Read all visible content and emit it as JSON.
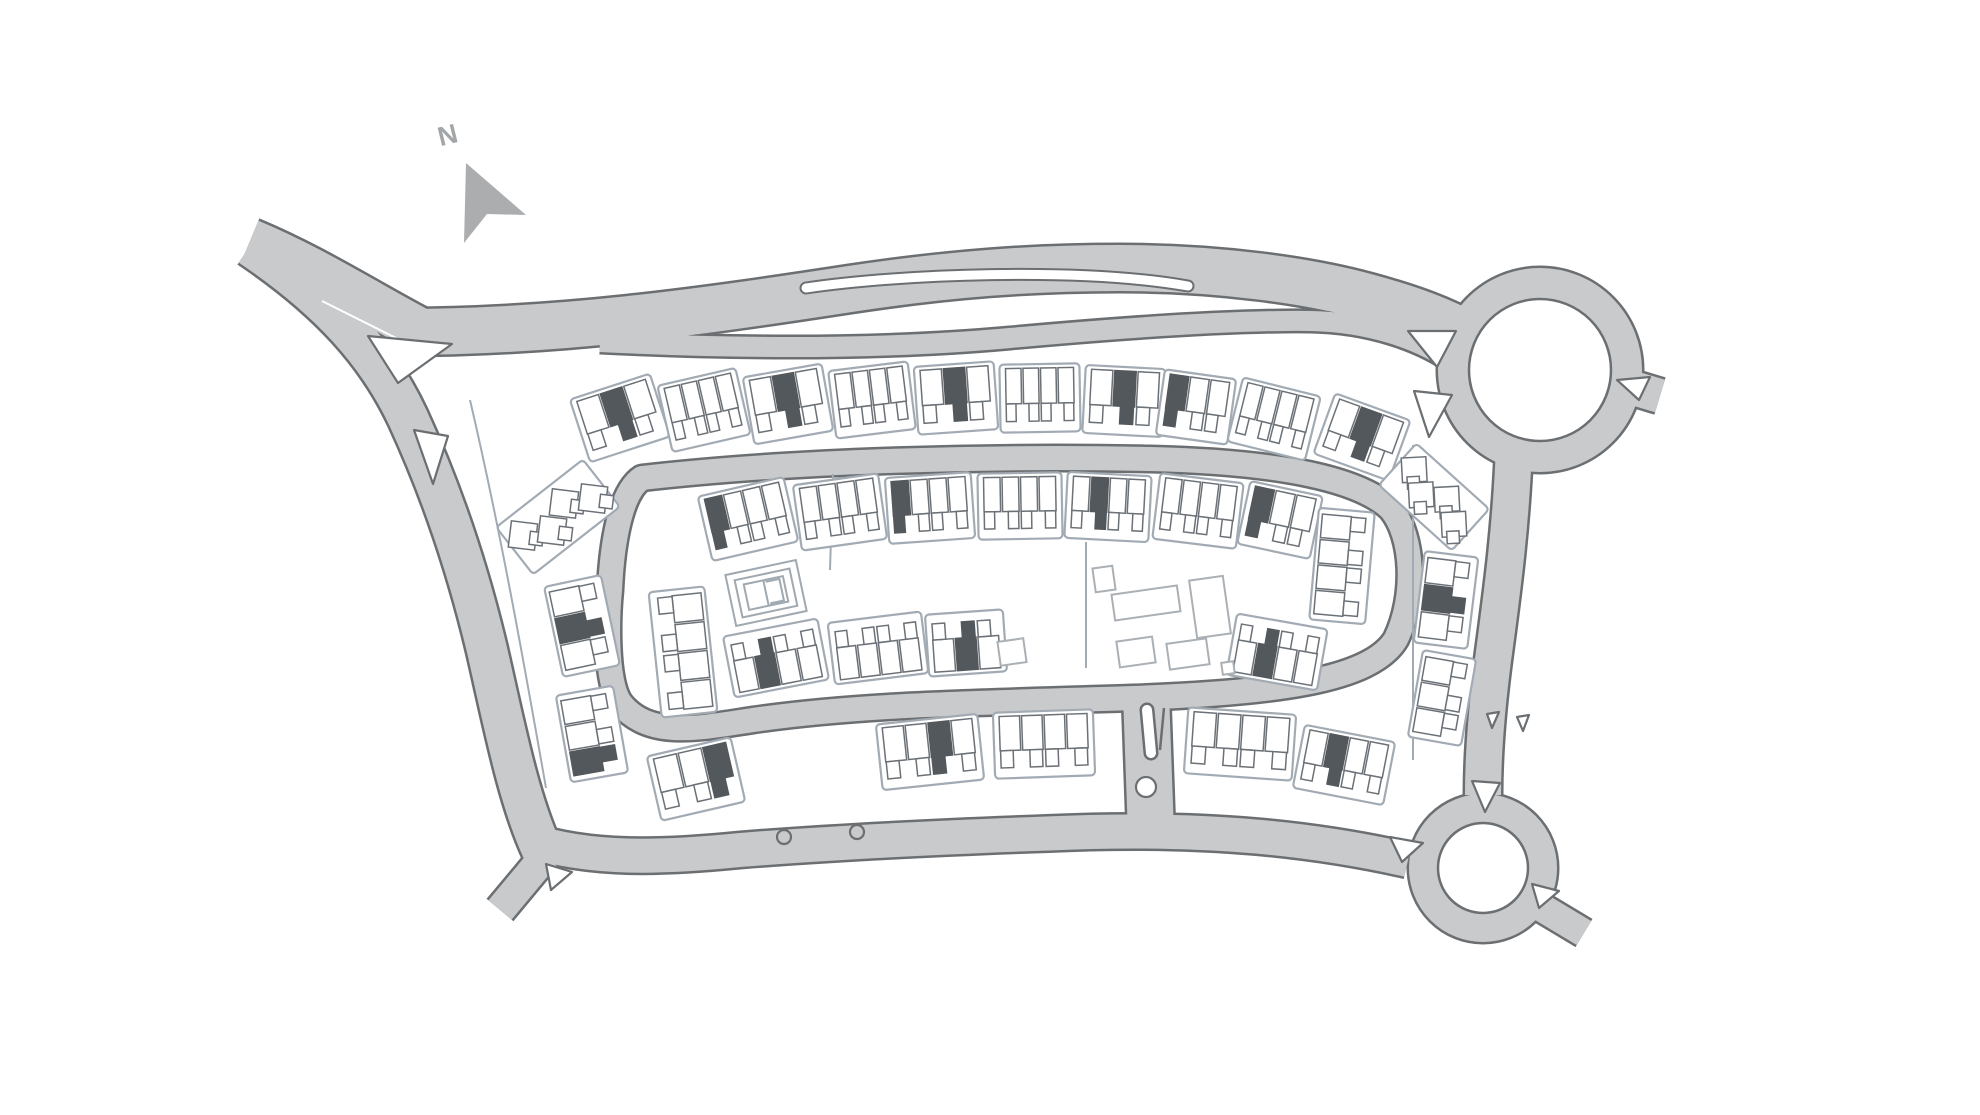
{
  "meta": {
    "title": "Development site plan"
  },
  "palette": {
    "background": "#ffffff",
    "road_fill": "#c9cacc",
    "road_casing": "#6b6f72",
    "parcel_stroke": "#a2abb4",
    "house_stroke": "#6b7177",
    "house_fill": "#ffffff",
    "unit_dark": "#53585c",
    "community_stroke": "#aab0b5",
    "play_stroke": "#a0a8b0",
    "arrow_fill": "#abadae",
    "label_color": "#a3a6a8",
    "lane_line": "#ffffff"
  },
  "compass": {
    "label": "N",
    "arrow_points": "466,163 526,215 487,214 464,243",
    "label_x": 438,
    "label_y": 120,
    "label_rotation": -14
  },
  "roads": [
    {
      "id": "entry-west",
      "d": "M 250,241 C 310,266 360,298 416,328",
      "w": 44
    },
    {
      "id": "main-avenue",
      "d": "M 398,332 C 560,332 700,312 850,289 C 950,274 1030,268 1120,268 C 1220,268 1310,281 1368,297 C 1412,309 1444,321 1470,336",
      "w": 46
    },
    {
      "id": "service-road",
      "d": "M 600,342 C 760,350 900,348 1010,338 C 1120,328 1230,320 1310,321 C 1370,322 1420,340 1452,362",
      "w": 20
    },
    {
      "id": "west-boundary",
      "d": "M 250,246 C 330,300 378,354 408,418 C 443,494 468,570 487,650 C 504,724 518,798 542,850",
      "w": 40
    },
    {
      "id": "south-boundary",
      "d": "M 528,840 C 590,860 660,858 740,850 C 840,842 970,836 1090,832 C 1210,829 1310,838 1408,860",
      "w": 34
    },
    {
      "id": "southwest-exit",
      "d": "M 545,856 L 500,910",
      "w": 30
    },
    {
      "id": "east-link",
      "d": "M 1514,446 C 1511,530 1501,600 1493,660 C 1487,706 1483,752 1483,795",
      "w": 36
    },
    {
      "id": "northeast-exit",
      "d": "M 1620,384 L 1660,396",
      "w": 34
    },
    {
      "id": "southeast-exit",
      "d": "M 1524,897 L 1584,933",
      "w": 28
    },
    {
      "id": "spine-connector",
      "d": "M 1146,694 L 1151,834",
      "w": 46
    },
    {
      "id": "inner-loop",
      "d": "M 642,478 C 800,460 1000,456 1150,459 C 1280,462 1360,479 1391,509 C 1414,537 1416,597 1396,639 C 1371,681 1273,693 1133,698 C 983,703 863,704 753,720 C 700,728 649,739 621,704 C 604,682 608,610 610,590 C 612,545 620,492 642,478 Z",
      "w": 24
    }
  ],
  "roundabouts": [
    {
      "id": "north",
      "cx": 1540,
      "cy": 370,
      "ring_r": 87,
      "ring_w": 30,
      "island_r": 71
    },
    {
      "id": "south",
      "cx": 1483,
      "cy": 868,
      "ring_r": 60,
      "ring_w": 28,
      "island_r": 45
    }
  ],
  "layby": {
    "d": "M 806,288 C 900,274 1080,267 1188,286",
    "casing_w": 13,
    "fill_w": 9
  },
  "lane_lines": [
    {
      "d": "M 322,301 L 452,366",
      "w": 2
    }
  ],
  "islands": [
    {
      "id": "fork-north",
      "points": "368,336 452,344 398,383"
    },
    {
      "id": "fork-south",
      "points": "414,430 448,436 433,484"
    },
    {
      "id": "rb-north-west",
      "points": "1408,331 1456,331 1437,367"
    },
    {
      "id": "rb-north-southwest",
      "points": "1414,391 1452,395 1429,437"
    },
    {
      "id": "rb-north-east",
      "points": "1617,380 1650,377 1639,400"
    },
    {
      "id": "rb-south-north",
      "points": "1472,781 1500,783 1485,812"
    },
    {
      "id": "rb-south-west",
      "points": "1390,837 1423,843 1402,862"
    },
    {
      "id": "rb-south-southeast",
      "points": "1532,884 1559,891 1539,908"
    },
    {
      "id": "southwest-corner",
      "points": "546,864 572,872 551,890"
    },
    {
      "id": "east-link-notch-a",
      "points": "1487,714 1499,712 1492,728"
    },
    {
      "id": "east-link-notch-b",
      "points": "1517,717 1529,715 1523,731"
    }
  ],
  "median_ovals": [
    {
      "d": "M 1147,710 L 1151,753",
      "casing_w": 15,
      "fill_w": 10
    }
  ],
  "median_circle": {
    "cx": 1146,
    "cy": 787,
    "r": 10
  },
  "median_slit": {
    "d": "M 1164,708 L 1160,750",
    "w": 2.5
  },
  "kerb_bumps": [
    {
      "cx": 784,
      "cy": 837,
      "r": 7
    },
    {
      "cx": 857,
      "cy": 832,
      "r": 7
    }
  ],
  "lot_lines": [
    "M 833,474 L 830,570",
    "M 1086,542 L 1086,668",
    "M 470,400 C 498,520 520,640 546,788",
    "M 1413,445 L 1413,760"
  ],
  "parcels": [
    {
      "id": "north-outer-1",
      "cx": 620,
      "cy": 418,
      "angle": -18,
      "len": 84,
      "depth": 66,
      "units": 3,
      "dark": [
        1
      ]
    },
    {
      "id": "north-outer-2",
      "cx": 704,
      "cy": 410,
      "angle": -13,
      "len": 80,
      "depth": 68,
      "units": 4,
      "dark": []
    },
    {
      "id": "north-outer-3",
      "cx": 788,
      "cy": 404,
      "angle": -10,
      "len": 80,
      "depth": 68,
      "units": 3,
      "dark": [
        1
      ]
    },
    {
      "id": "north-outer-4",
      "cx": 872,
      "cy": 400,
      "angle": -7,
      "len": 80,
      "depth": 68,
      "units": 4,
      "dark": []
    },
    {
      "id": "north-outer-5",
      "cx": 956,
      "cy": 398,
      "angle": -4,
      "len": 80,
      "depth": 68,
      "units": 3,
      "dark": [
        1
      ]
    },
    {
      "id": "north-outer-6",
      "cx": 1040,
      "cy": 398,
      "angle": -1,
      "len": 80,
      "depth": 68,
      "units": 4,
      "dark": []
    },
    {
      "id": "north-outer-7",
      "cx": 1124,
      "cy": 401,
      "angle": 3,
      "len": 80,
      "depth": 68,
      "units": 3,
      "dark": [
        1
      ]
    },
    {
      "id": "north-outer-8",
      "cx": 1196,
      "cy": 407,
      "angle": 8,
      "len": 72,
      "depth": 66,
      "units": 3,
      "dark": [
        0
      ]
    },
    {
      "id": "north-outer-9",
      "cx": 1274,
      "cy": 419,
      "angle": 14,
      "len": 80,
      "depth": 66,
      "units": 4,
      "dark": []
    },
    {
      "id": "north-outer-10",
      "cx": 1362,
      "cy": 437,
      "angle": 20,
      "len": 80,
      "depth": 64,
      "units": 3,
      "dark": [
        1
      ]
    },
    {
      "id": "north-inner-1",
      "cx": 748,
      "cy": 519,
      "angle": -13,
      "len": 88,
      "depth": 66,
      "units": 4,
      "dark": [
        0
      ]
    },
    {
      "id": "north-inner-2",
      "cx": 840,
      "cy": 512,
      "angle": -8,
      "len": 86,
      "depth": 66,
      "units": 4,
      "dark": []
    },
    {
      "id": "north-inner-3",
      "cx": 930,
      "cy": 508,
      "angle": -4,
      "len": 86,
      "depth": 66,
      "units": 4,
      "dark": [
        0
      ]
    },
    {
      "id": "north-inner-4",
      "cx": 1020,
      "cy": 506,
      "angle": -1,
      "len": 84,
      "depth": 66,
      "units": 4,
      "dark": []
    },
    {
      "id": "north-inner-5",
      "cx": 1108,
      "cy": 507,
      "angle": 3,
      "len": 84,
      "depth": 66,
      "units": 4,
      "dark": [
        1
      ]
    },
    {
      "id": "north-inner-6",
      "cx": 1198,
      "cy": 511,
      "angle": 7,
      "len": 84,
      "depth": 66,
      "units": 4,
      "dark": []
    },
    {
      "id": "north-inner-7",
      "cx": 1280,
      "cy": 520,
      "angle": 12,
      "len": 74,
      "depth": 64,
      "units": 3,
      "dark": [
        0
      ]
    },
    {
      "id": "south-inner-1",
      "cx": 776,
      "cy": 658,
      "angle": -11,
      "len": 96,
      "depth": 62,
      "units": 4,
      "dark": [
        1
      ],
      "flip": true
    },
    {
      "id": "south-inner-2",
      "cx": 878,
      "cy": 648,
      "angle": -7,
      "len": 94,
      "depth": 62,
      "units": 4,
      "dark": [],
      "flip": true
    },
    {
      "id": "south-inner-3",
      "cx": 966,
      "cy": 643,
      "angle": -4,
      "len": 78,
      "depth": 62,
      "units": 3,
      "dark": [
        1
      ],
      "flip": true
    },
    {
      "id": "south-inner-4",
      "cx": 1277,
      "cy": 652,
      "angle": 10,
      "len": 92,
      "depth": 62,
      "units": 4,
      "dark": [
        1
      ],
      "flip": true
    },
    {
      "id": "south-outer-1",
      "cx": 696,
      "cy": 779,
      "angle": -13,
      "len": 86,
      "depth": 66,
      "units": 3,
      "dark": [
        2
      ]
    },
    {
      "id": "south-outer-2",
      "cx": 930,
      "cy": 752,
      "angle": -6,
      "len": 102,
      "depth": 66,
      "units": 4,
      "dark": [
        2
      ]
    },
    {
      "id": "south-outer-3",
      "cx": 1044,
      "cy": 744,
      "angle": -2,
      "len": 100,
      "depth": 66,
      "units": 4,
      "dark": []
    },
    {
      "id": "south-outer-4",
      "cx": 1240,
      "cy": 744,
      "angle": 4,
      "len": 108,
      "depth": 66,
      "units": 4,
      "dark": []
    },
    {
      "id": "south-outer-5",
      "cx": 1344,
      "cy": 765,
      "angle": 11,
      "len": 92,
      "depth": 64,
      "units": 4,
      "dark": [
        1
      ]
    },
    {
      "id": "west-terrace-1",
      "cx": 582,
      "cy": 626,
      "angle": 78,
      "len": 92,
      "depth": 58,
      "units": 3,
      "dark": [
        1
      ],
      "flip": true
    },
    {
      "id": "west-terrace-2",
      "cx": 592,
      "cy": 734,
      "angle": 80,
      "len": 88,
      "depth": 58,
      "units": 3,
      "dark": [
        2
      ],
      "flip": true
    },
    {
      "id": "loop-west-terrace",
      "cx": 683,
      "cy": 652,
      "angle": 84,
      "len": 126,
      "depth": 56,
      "units": 4,
      "dark": []
    },
    {
      "id": "loop-east-terrace",
      "cx": 1342,
      "cy": 566,
      "angle": 95,
      "len": 112,
      "depth": 56,
      "units": 4,
      "dark": [],
      "flip": true
    },
    {
      "id": "east-terrace-1",
      "cx": 1446,
      "cy": 600,
      "angle": 97,
      "len": 92,
      "depth": 54,
      "units": 3,
      "dark": [
        1
      ],
      "flip": true
    },
    {
      "id": "east-terrace-2",
      "cx": 1442,
      "cy": 698,
      "angle": 100,
      "len": 88,
      "depth": 54,
      "units": 3,
      "dark": [],
      "flip": true
    },
    {
      "id": "west-corner-court",
      "type": "angled",
      "cx": 558,
      "cy": 517,
      "angle": -38,
      "len": 110,
      "depth": 60
    },
    {
      "id": "east-corner-court",
      "type": "angled",
      "cx": 1434,
      "cy": 497,
      "angle": 42,
      "len": 98,
      "depth": 56
    }
  ],
  "community_buildings": [
    {
      "id": "hall",
      "cx": 1146,
      "cy": 603,
      "w": 66,
      "h": 26,
      "angle": -8
    },
    {
      "id": "tower",
      "cx": 1210,
      "cy": 607,
      "w": 34,
      "h": 58,
      "angle": -8
    },
    {
      "id": "annex-nw",
      "cx": 1104,
      "cy": 579,
      "w": 20,
      "h": 24,
      "angle": -8
    },
    {
      "id": "annex-s1",
      "cx": 1136,
      "cy": 652,
      "w": 36,
      "h": 26,
      "angle": -8
    },
    {
      "id": "annex-s2",
      "cx": 1188,
      "cy": 654,
      "w": 40,
      "h": 26,
      "angle": -8
    },
    {
      "id": "annex-w",
      "cx": 1012,
      "cy": 652,
      "w": 26,
      "h": 24,
      "angle": -8
    },
    {
      "id": "kiosk",
      "cx": 1228,
      "cy": 668,
      "w": 12,
      "h": 12,
      "angle": -8
    }
  ],
  "play_area": {
    "cx": 766,
    "cy": 593,
    "angle": -12,
    "rects": [
      [
        72,
        52
      ],
      [
        56,
        38
      ],
      [
        40,
        26
      ]
    ]
  }
}
